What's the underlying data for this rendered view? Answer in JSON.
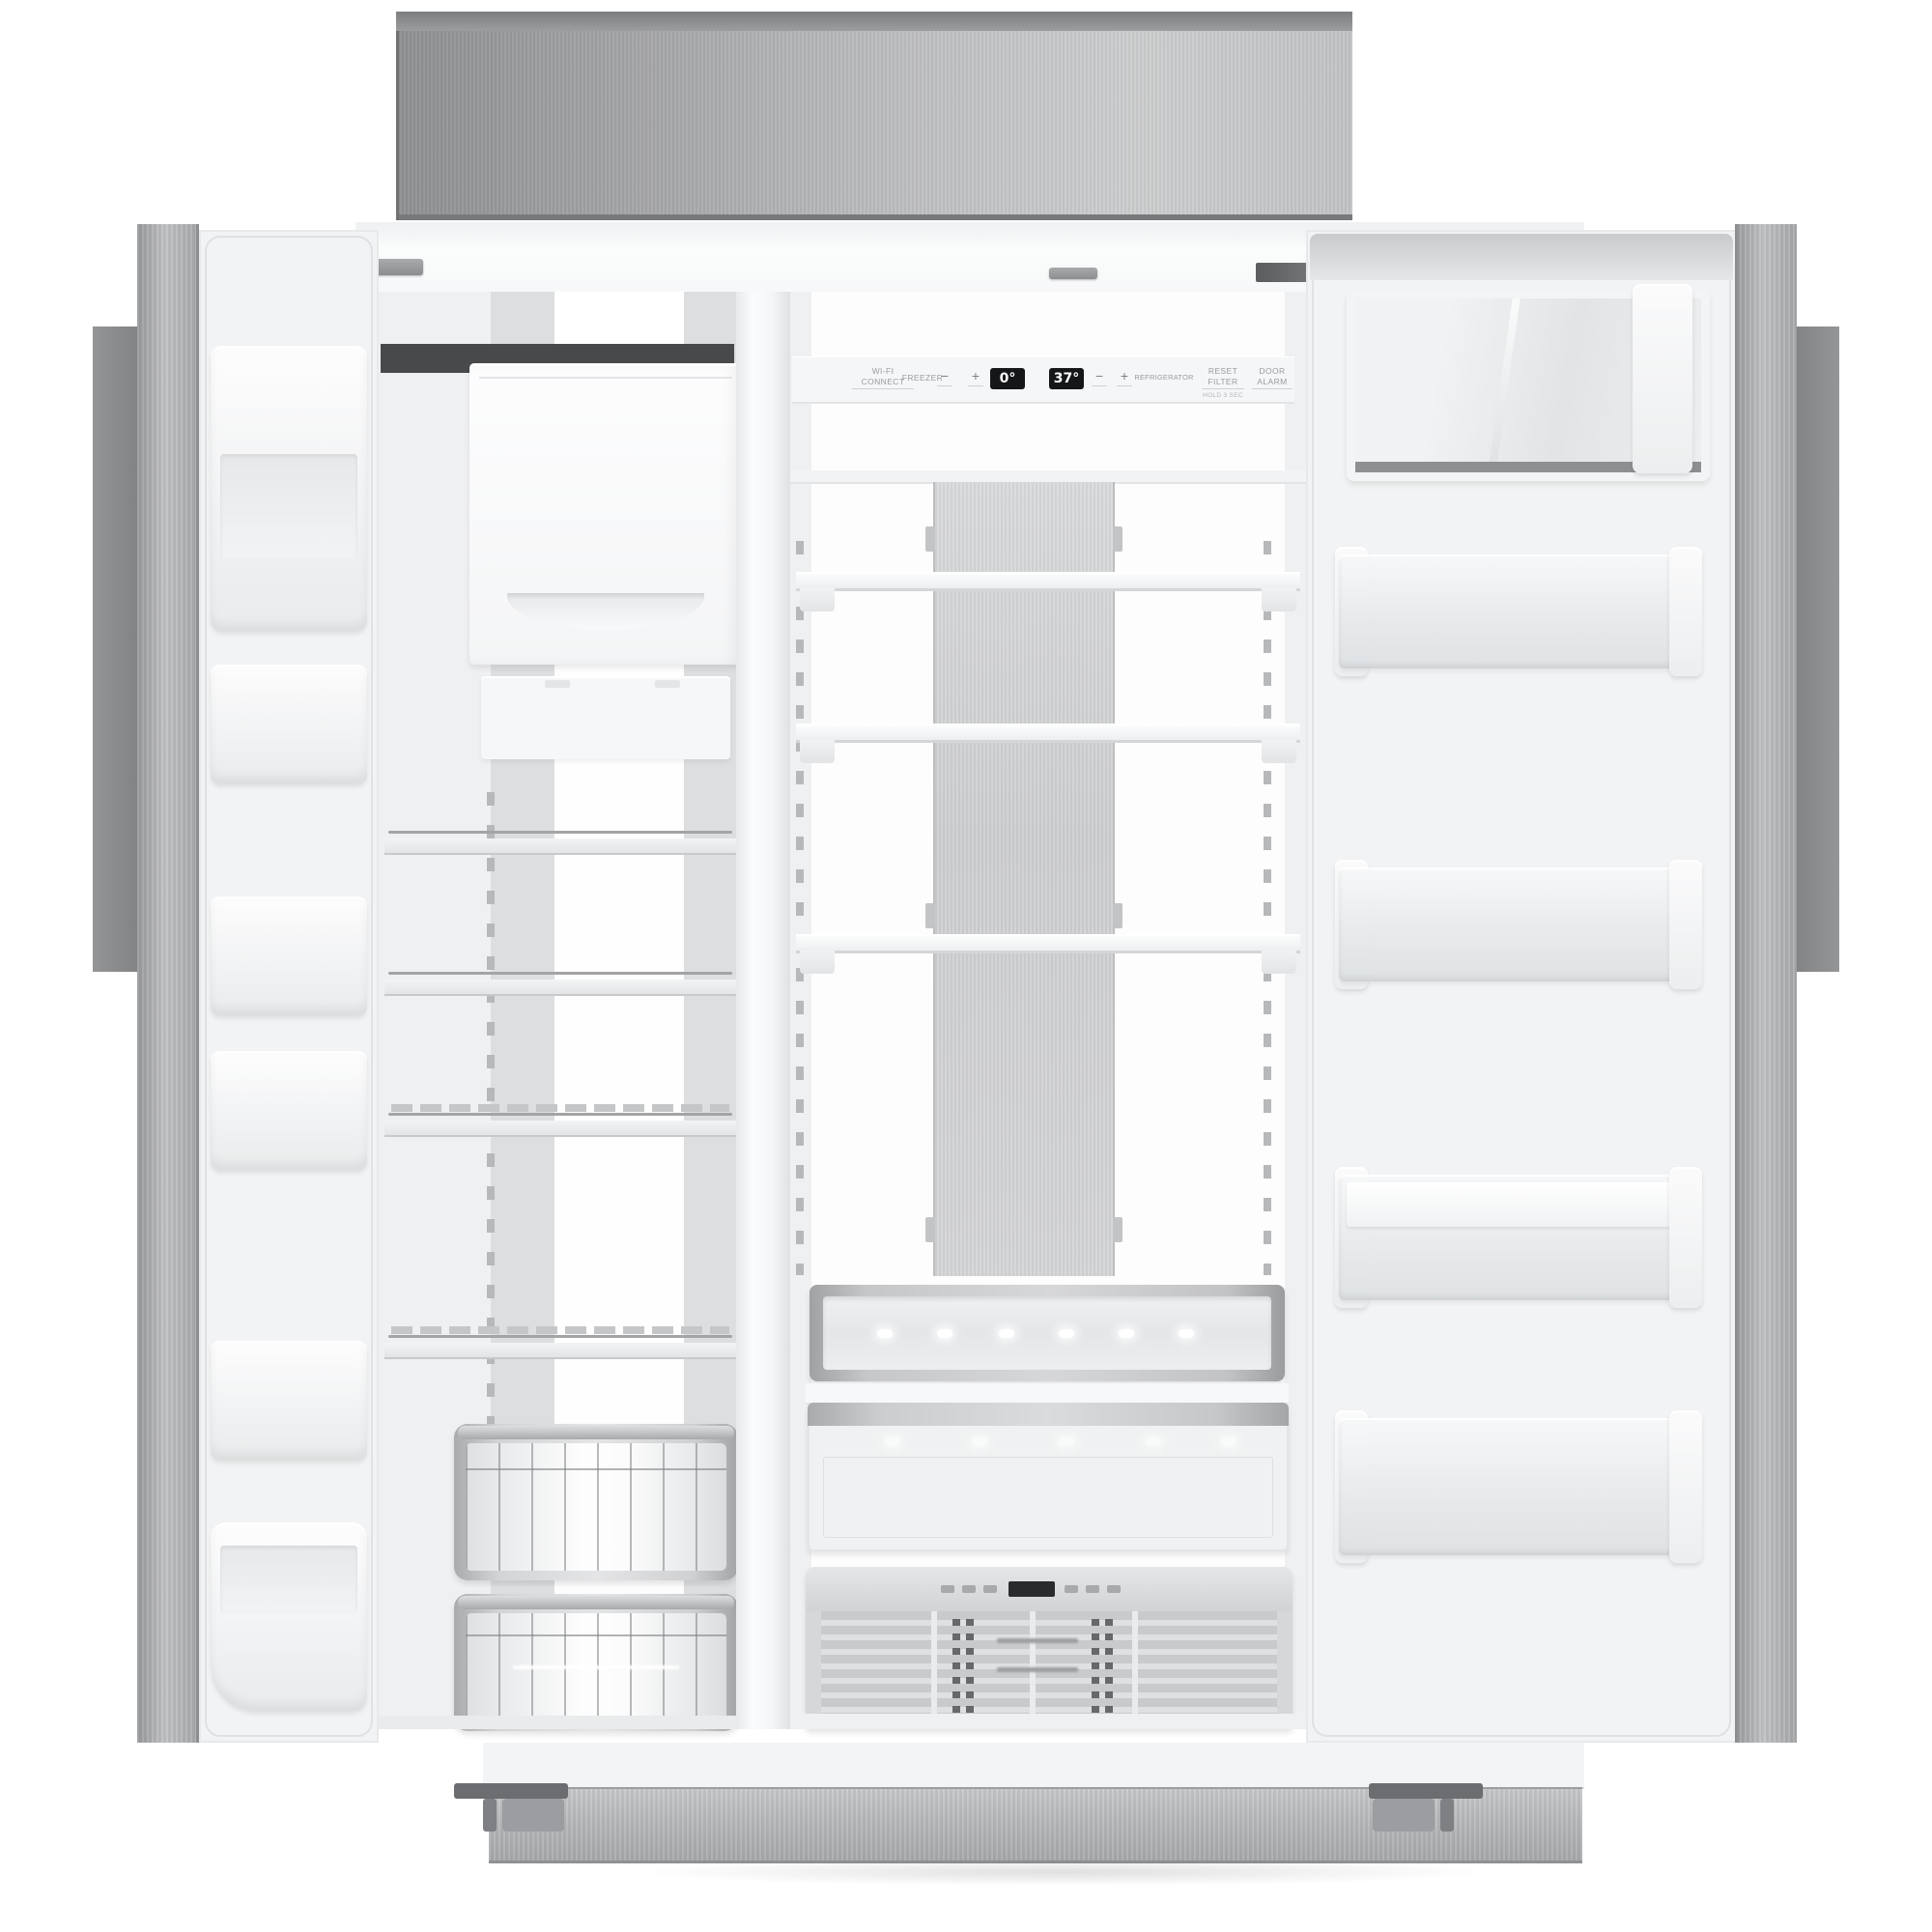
{
  "scene": {
    "name": "built-in side-by-side refrigerator with doors open",
    "description": "Stainless steel built-in side-by-side refrigerator shown front-on with both doors open and empty interior: freezer with ice bin, wire shelves and pull-out baskets on the left; refrigerator with glass shelves, stainless back accent panel and three drawers on the right; white door bins on both doors; stainless hood above and kickplate below"
  },
  "colors": {
    "background": "#ffffff",
    "stainless_dark": "#8e9092",
    "stainless_light": "#cdcecf",
    "liner_white": "#f2f3f4",
    "display_bg": "#151618",
    "display_text": "#ffffff",
    "led": "#ffffff"
  },
  "control_panel": {
    "wifi": {
      "line1": "WI-FI",
      "line2": "CONNECT"
    },
    "freezer_label": "FREEZER",
    "freezer_minus": "−",
    "freezer_plus": "+",
    "freezer_temp": "0°",
    "fridge_temp": "37°",
    "fridge_minus": "−",
    "fridge_plus": "+",
    "refrigerator_label": "REFRIGERATOR",
    "reset_filter": {
      "line1": "RESET",
      "line2": "FILTER",
      "sub": "HOLD 3 SEC"
    },
    "door_alarm": {
      "line1": "DOOR",
      "line2": "ALARM"
    }
  },
  "convertible_drawer": {
    "display_value": ""
  }
}
